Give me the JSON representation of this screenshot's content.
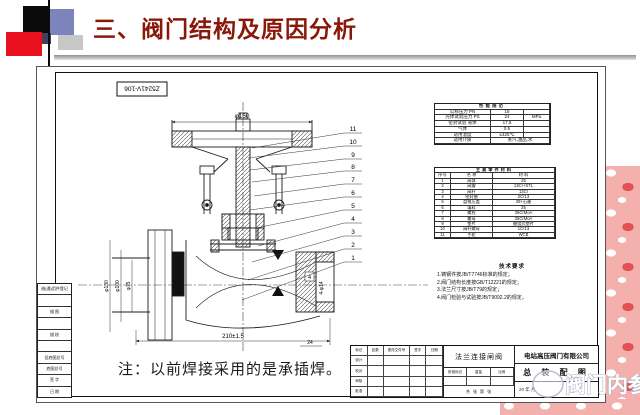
{
  "slide": {
    "title": "三、阀门结构及原因分析"
  },
  "colors": {
    "title_text": "#8a1708",
    "square_black": "#0b0b0b",
    "square_blue": "#7d84bb",
    "square_red": "#e8101f",
    "square_gray": "#c7c7c7",
    "square_dark": "#3d4458",
    "pink_bg": "#f4b0ac"
  },
  "watermark": {
    "text": "阀门内参"
  },
  "drawing": {
    "number": "Z5241V-106",
    "note": "注：以前焊接采用的是承插焊。",
    "dimensions": {
      "wheel": "φ160",
      "flange_od": "φ130",
      "bolt_circle": "φ100",
      "bore": "φ75",
      "length": "210±1.5",
      "holes": "4-φ14",
      "depth": "24",
      "weld": "4"
    },
    "part_numbers": [
      "11",
      "10",
      "9",
      "8",
      "7",
      "6",
      "5",
      "4",
      "3",
      "2",
      "1"
    ],
    "perf_table": {
      "title": "性能规范",
      "rows": [
        {
          "label": "公称压力 PN",
          "value": "16",
          "unit": ""
        },
        {
          "label": "壳体试验压力 PS",
          "value": "24",
          "unit": "MPa"
        },
        {
          "label": "密封试验 液体",
          "value": "17.6",
          "unit": ""
        },
        {
          "label": "气体",
          "value": "0.5",
          "unit": ""
        },
        {
          "label": "适用温度",
          "value": "≤425℃",
          "unit": ""
        },
        {
          "label": "适用介质",
          "value": "蒸汽,油品,水",
          "unit": ""
        }
      ]
    },
    "materials_table": {
      "title": "主要零件材料",
      "headers": [
        "序号",
        "名 称",
        "材 料"
      ],
      "rows": [
        {
          "n": "1",
          "name": "阀体",
          "mat": "25"
        },
        {
          "n": "2",
          "name": "阀瓣",
          "mat": "13Cr+STL"
        },
        {
          "n": "3",
          "name": "阀杆",
          "mat": "13Cr"
        },
        {
          "n": "4",
          "name": "密封圈",
          "mat": "2Cr13"
        },
        {
          "n": "5",
          "name": "盘根压盖",
          "mat": "38+石墨"
        },
        {
          "n": "6",
          "name": "填料",
          "mat": "25"
        },
        {
          "n": "7",
          "name": "螺栓",
          "mat": "35CrMoA"
        },
        {
          "n": "8",
          "name": "螺母",
          "mat": "35CrMoA"
        },
        {
          "n": "9",
          "name": "垫片",
          "mat": "缠绕式垫片"
        },
        {
          "n": "10",
          "name": "阀杆螺母",
          "mat": "1Cr13"
        },
        {
          "n": "11",
          "name": "手轮",
          "mat": "WCB"
        }
      ]
    },
    "tech_requirements": {
      "title": "技术要求",
      "lines": [
        "1.铸钢件按JB/T7746标准的规定；",
        "2.阀门结构长度按GB/T12221的规定；",
        "3.法兰尺寸按JB/T79的规定；",
        "4.阀门检验与试验按JB/T9092.2的规定。"
      ]
    },
    "title_block": {
      "company": "电站高压阀门有限公司",
      "drawing_title": "总 装 配 图",
      "product": "法兰连接闸阀",
      "rev_headers": [
        "标记",
        "处数",
        "更改文件号",
        "签字",
        "日期"
      ],
      "sign_rows": [
        "设计",
        "校对",
        "审核",
        "批准"
      ],
      "stage_cells": [
        "阶段标记",
        "重量",
        "比例"
      ],
      "sheet_info": "共 张  第 张",
      "date": "20  年  月"
    },
    "margin_table": {
      "rows": [
        "借(通)用件登记",
        "",
        "描 图",
        "",
        "描 校",
        "",
        "旧底图总号",
        "底图总号",
        "签 字",
        "日 期"
      ]
    }
  }
}
